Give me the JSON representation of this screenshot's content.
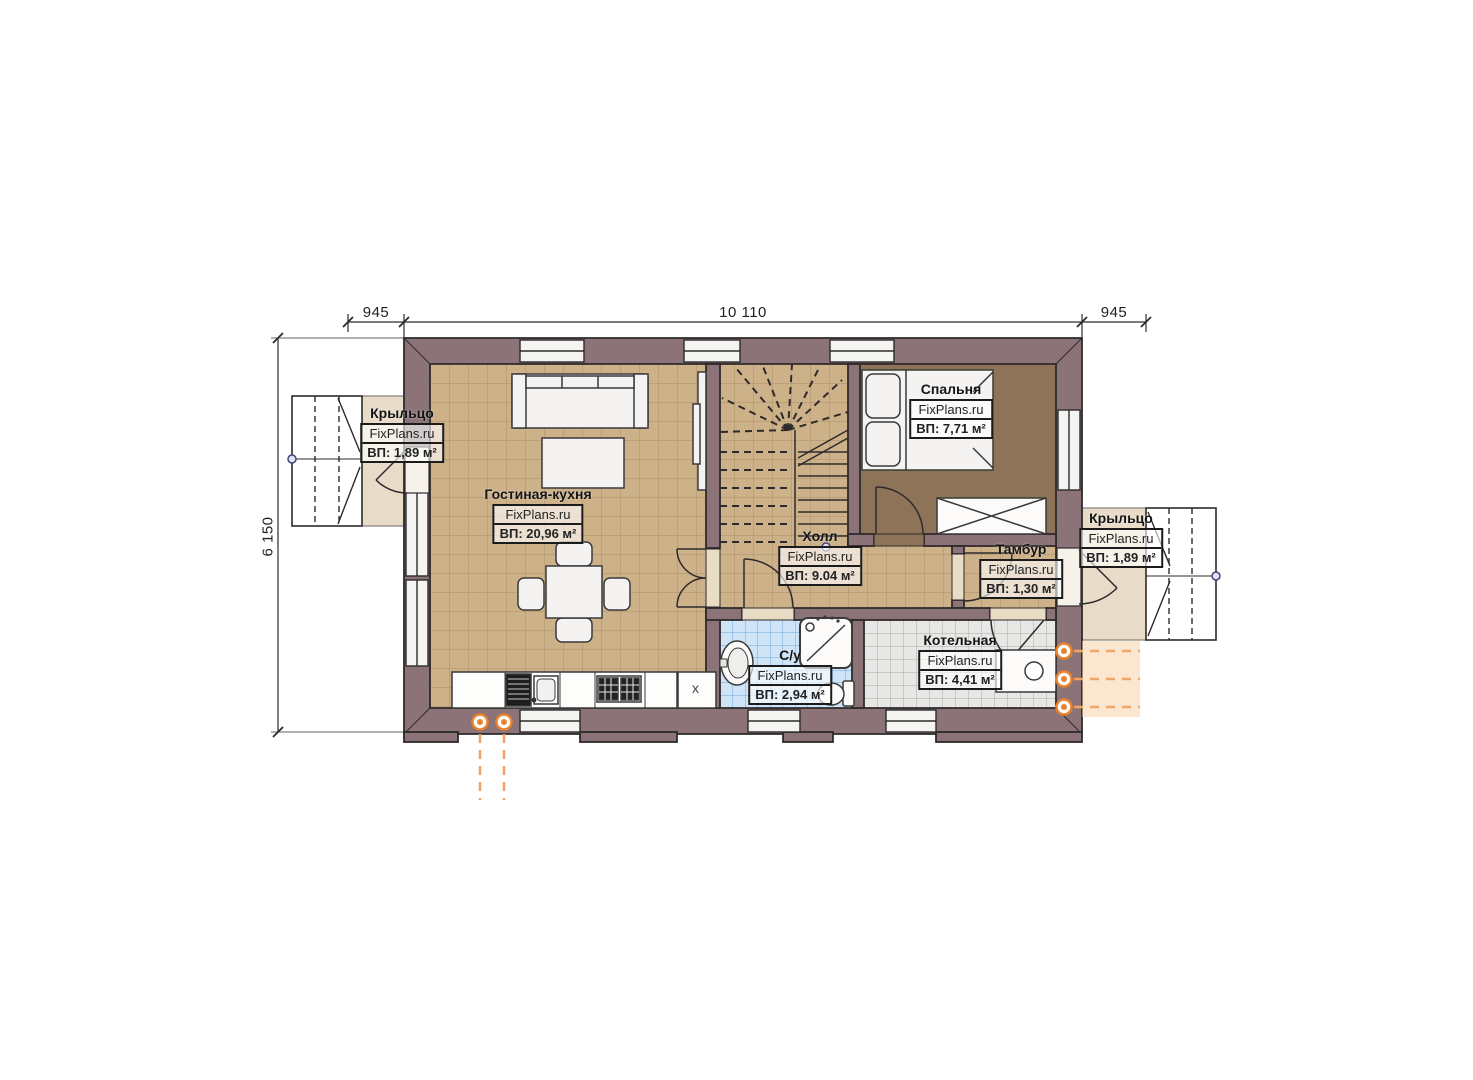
{
  "watermark": "FixPlans.ru",
  "dimensions": {
    "top_left": "945",
    "top_center": "10 110",
    "top_right": "945",
    "left": "6 150"
  },
  "rooms": {
    "porch_left": {
      "name": "Крыльцо",
      "area": "ВП: 1,89 м²"
    },
    "living": {
      "name": "Гостиная-кухня",
      "area": "ВП: 20,96 м²"
    },
    "bedroom": {
      "name": "Спальня",
      "area": "ВП: 7,71 м²"
    },
    "hall": {
      "name": "Холл",
      "area": "ВП: 9.04 м²"
    },
    "tambour": {
      "name": "Тамбур",
      "area": "ВП: 1,30 м²"
    },
    "porch_right": {
      "name": "Крыльцо",
      "area": "ВП: 1,89 м²"
    },
    "bathroom": {
      "name": "С/у",
      "area": "ВП: 2,94 м²"
    },
    "boiler": {
      "name": "Котельная",
      "area": "ВП: 4,41 м²"
    }
  },
  "kitchen": {
    "cabinet_mark": "x"
  },
  "colors": {
    "wall": "#8b7378",
    "floor_tan": "#cdb189",
    "floor_bedroom": "#8d7459",
    "floor_bath": "#cfe4f7",
    "floor_boiler": "#e7e7e5",
    "floor_porch": "#e8dcc9",
    "utility_orange": "#e8822e",
    "axis_blue": "#43437f"
  }
}
